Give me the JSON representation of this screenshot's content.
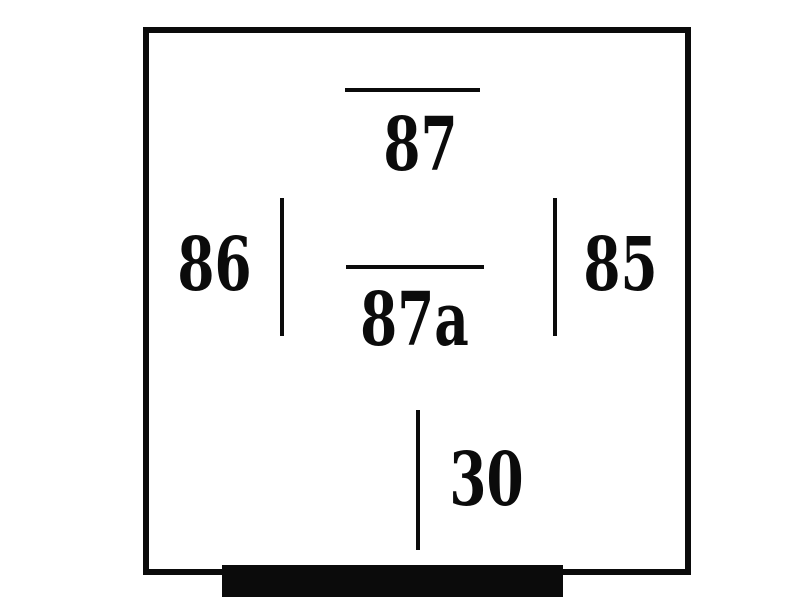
{
  "diagram": {
    "pins": {
      "pin87": {
        "label": "87"
      },
      "pin86": {
        "label": "86"
      },
      "pin87a": {
        "label": "87a"
      },
      "pin85": {
        "label": "85"
      },
      "pin30": {
        "label": "30"
      }
    },
    "colors": {
      "foreground": "#0b0b0b",
      "background": "#ffffff"
    }
  }
}
